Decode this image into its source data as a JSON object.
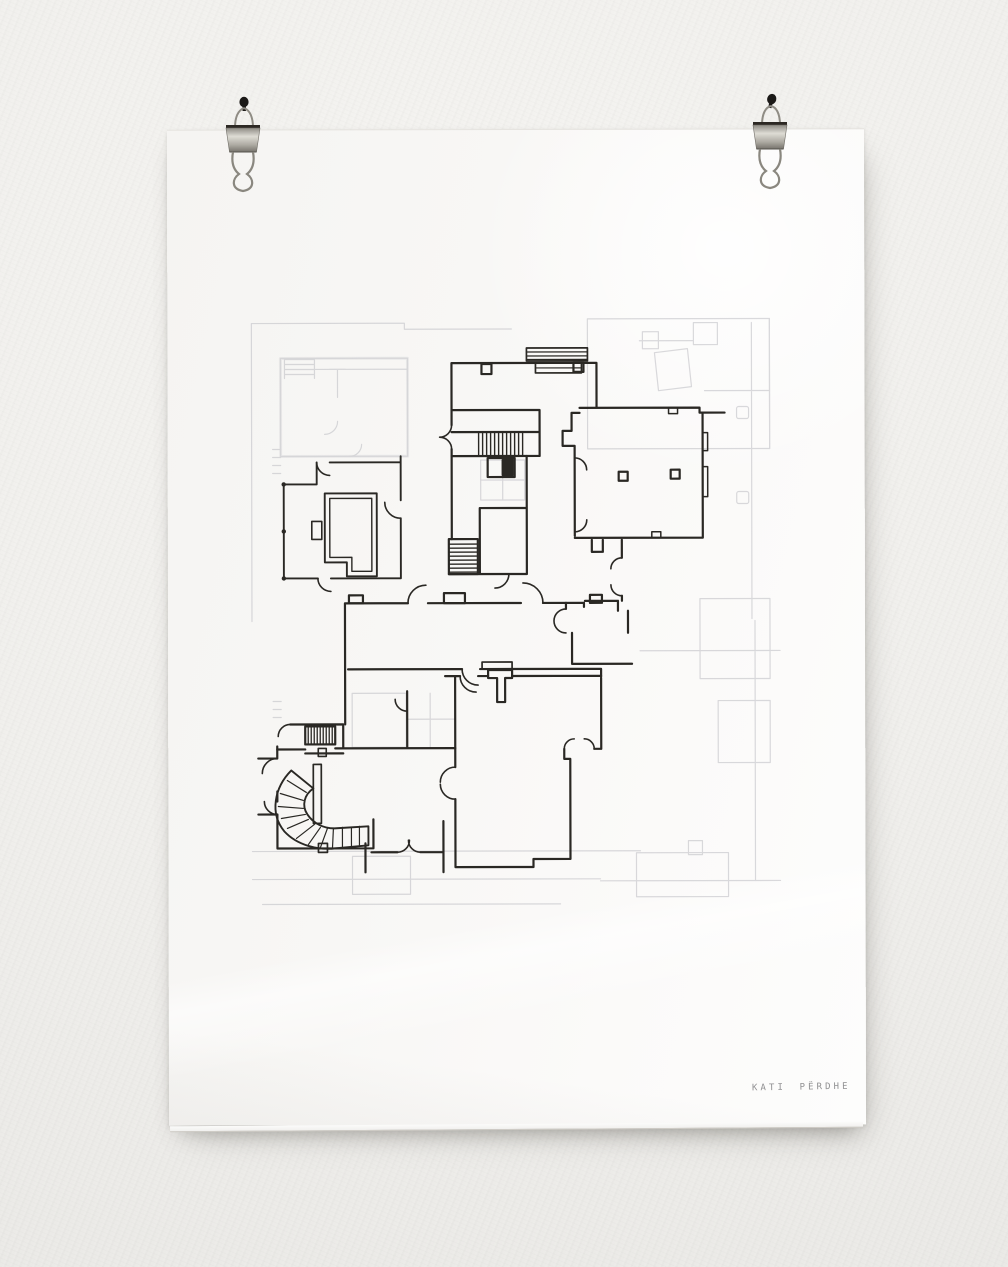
{
  "scene": {
    "description": "Photograph of a hand-drawn architectural ground-floor plan in black ink on translucent tracing paper, hung on a white plaster wall with two small binder clips on nails; a fainter printed floor plan shows through the vellum",
    "wall_color": "#f0efec",
    "shadow_color": "#b5b2ab"
  },
  "clips": {
    "count": 2,
    "left": {
      "kind": "binder-clip-on-nail",
      "metal_color": "#b3b0a8",
      "pin_color": "#1b1917"
    },
    "right": {
      "kind": "binder-clip-on-nail",
      "metal_color": "#b3b0a8",
      "pin_color": "#1b1917"
    }
  },
  "paper": {
    "color": "#fafaf8",
    "type": "translucent-tracing-sheet",
    "caption": "KATI PËRDHE",
    "caption_color": "#8f8f91"
  },
  "drawing": {
    "ink_color": "#2a2824",
    "underlay_color": "#bcbcc2",
    "elements": [
      "top-room-with-columns",
      "entry-double-door",
      "main-straight-staircase",
      "elevator-shaft",
      "large-hall-with-two-columns",
      "left-room-with-built-in-island",
      "central-service-rooms",
      "long-corridor",
      "lower-hall-with-t-pier",
      "spiral-staircase",
      "small-straight-stair",
      "door-swing-arcs",
      "faint-printed-underlay-plan"
    ]
  }
}
